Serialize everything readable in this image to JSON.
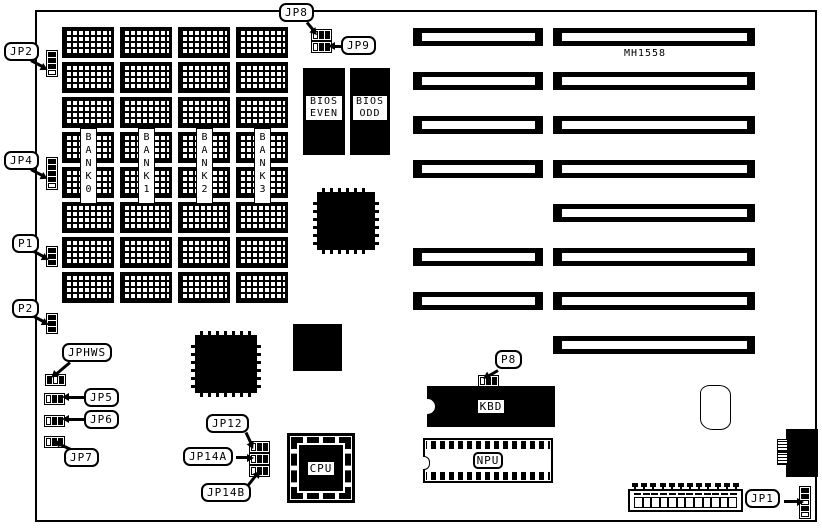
{
  "board": {
    "model": "MH1558"
  },
  "memory": {
    "chip_columns": 4,
    "chip_rows": 8,
    "bank_labels": [
      "BANK 0",
      "BANK 1",
      "BANK 2",
      "BANK 3"
    ]
  },
  "chips": {
    "bios_even": [
      "BIOS",
      "EVEN"
    ],
    "bios_odd": [
      "BIOS",
      "ODD"
    ],
    "kbd": "KBD",
    "npu": "NPU",
    "cpu": "CPU"
  },
  "slots": {
    "count": 8,
    "segments_per_slot": [
      2,
      2,
      2,
      2,
      1,
      2,
      2,
      1
    ]
  },
  "jumpers": {
    "jp2": {
      "label": "JP2",
      "orientation": "v",
      "cells": [
        "closed",
        "closed",
        "closed",
        "open"
      ]
    },
    "jp4": {
      "label": "JP4",
      "orientation": "v",
      "cells": [
        "closed",
        "closed",
        "closed",
        "closed",
        "open"
      ]
    },
    "p1": {
      "label": "P1",
      "orientation": "v",
      "cells": [
        "closed",
        "closed",
        "closed"
      ]
    },
    "p2": {
      "label": "P2",
      "orientation": "v",
      "cells": [
        "closed",
        "closed",
        "closed"
      ]
    },
    "jp8": {
      "label": "JP8",
      "orientation": "h",
      "cells": [
        "open",
        "closed",
        "closed"
      ]
    },
    "jp9": {
      "label": "JP9",
      "orientation": "h",
      "cells": [
        "open",
        "closed",
        "closed"
      ]
    },
    "jphws": {
      "label": "JPHWS",
      "orientation": "h",
      "cells": [
        "closed",
        "open",
        "closed"
      ]
    },
    "jp5": {
      "label": "JP5",
      "orientation": "h",
      "cells": [
        "open",
        "closed",
        "closed"
      ]
    },
    "jp6": {
      "label": "JP6",
      "orientation": "h",
      "cells": [
        "open",
        "closed",
        "closed"
      ]
    },
    "jp7": {
      "label": "JP7",
      "orientation": "h",
      "cells": [
        "open",
        "closed",
        "closed"
      ]
    },
    "jp12": {
      "label": "JP12",
      "orientation": "h",
      "cells": [
        "open",
        "closed",
        "closed"
      ]
    },
    "jp14a": {
      "label": "JP14A",
      "orientation": "h",
      "cells": [
        "open",
        "closed",
        "closed"
      ]
    },
    "jp14b": {
      "label": "JP14B",
      "orientation": "h",
      "cells": [
        "open",
        "closed",
        "closed"
      ]
    },
    "p8": {
      "label": "P8",
      "orientation": "h",
      "cells": [
        "open",
        "closed",
        "closed"
      ]
    },
    "jp1": {
      "label": "JP1",
      "orientation": "v",
      "cells": [
        "closed",
        "closed",
        "open",
        "closed",
        "open"
      ]
    }
  },
  "connectors": {
    "power_pin_count": 12
  }
}
